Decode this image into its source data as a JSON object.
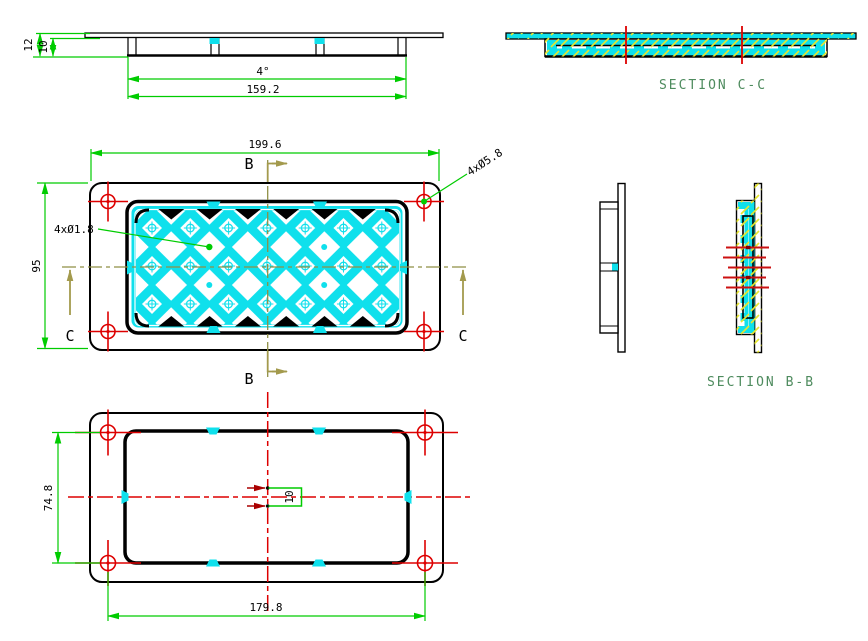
{
  "labels": {
    "section_cc": "SECTION C-C",
    "section_bb": "SECTION B-B",
    "cut_b": "B",
    "cut_c": "C"
  },
  "dimensions": {
    "side": {
      "height_overall": "12",
      "height_inner": "10",
      "draft_angle": "4°",
      "width_inner": "159.2"
    },
    "front": {
      "width_overall": "199.6",
      "height_overall": "95",
      "mount_holes": "4xØ5.8",
      "small_holes": "4xØ1.8"
    },
    "back": {
      "hole_pitch_vertical": "74.8",
      "hole_pitch_horizontal": "179.8",
      "center_tab": "10"
    }
  },
  "colors": {
    "dimension_green": "#00cc00",
    "centerline_red": "#dd0000",
    "centerline_olive": "#8f8f45",
    "section_arrow_olive": "#a39a4d",
    "panel_cyan": "#0fe0ec",
    "hatch_yellow": "#e6e62e",
    "section_label_green": "#4e8b5e",
    "outline_black": "#000000"
  }
}
